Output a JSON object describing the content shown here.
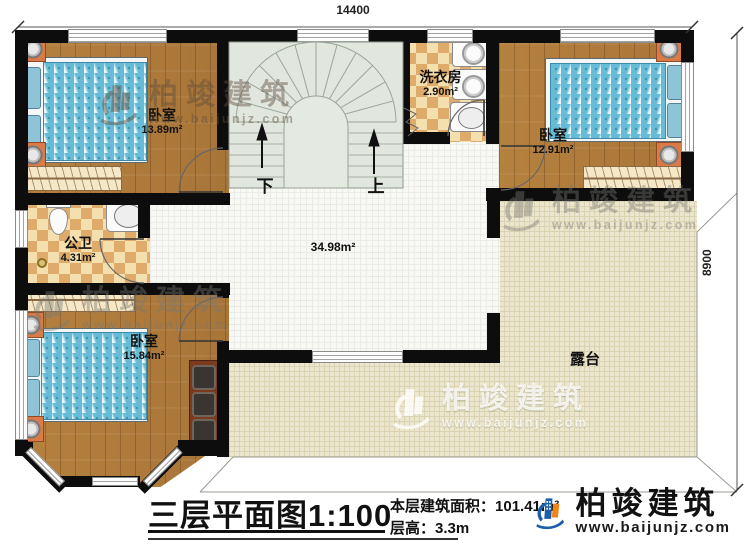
{
  "dimensions": {
    "top": "14400",
    "right": "8900"
  },
  "rooms": {
    "bedroom_tl": {
      "name": "卧室",
      "area": "13.89m²"
    },
    "bathroom": {
      "name": "公卫",
      "area": "4.31m²"
    },
    "laundry": {
      "name": "洗衣房",
      "area": "2.90m²"
    },
    "bedroom_tr": {
      "name": "卧室",
      "area": "12.91m²"
    },
    "bedroom_bl": {
      "name": "卧室",
      "area": "15.84m²"
    },
    "hall": {
      "area": "34.98m²"
    },
    "terrace": {
      "name": "露台"
    }
  },
  "stairs": {
    "down": "下",
    "up": "上"
  },
  "titleblock": {
    "title": "三层平面图",
    "scale": "1:100",
    "area_label": "本层建筑面积：",
    "area_value": "101.41m²",
    "height_label": "层高：",
    "height_value": "3.3m"
  },
  "brand": {
    "name": "柏竣建筑",
    "website": "www.baijunjz.com"
  },
  "watermark": {
    "name": "柏竣建筑",
    "website": "www.baijunjz.com"
  },
  "colors": {
    "wall": "#0d0d0d",
    "wood": "#b07d3d",
    "terrace": "#ebe6cd",
    "logo_blue": "#1c5fa8",
    "logo_orange": "#f08419"
  }
}
